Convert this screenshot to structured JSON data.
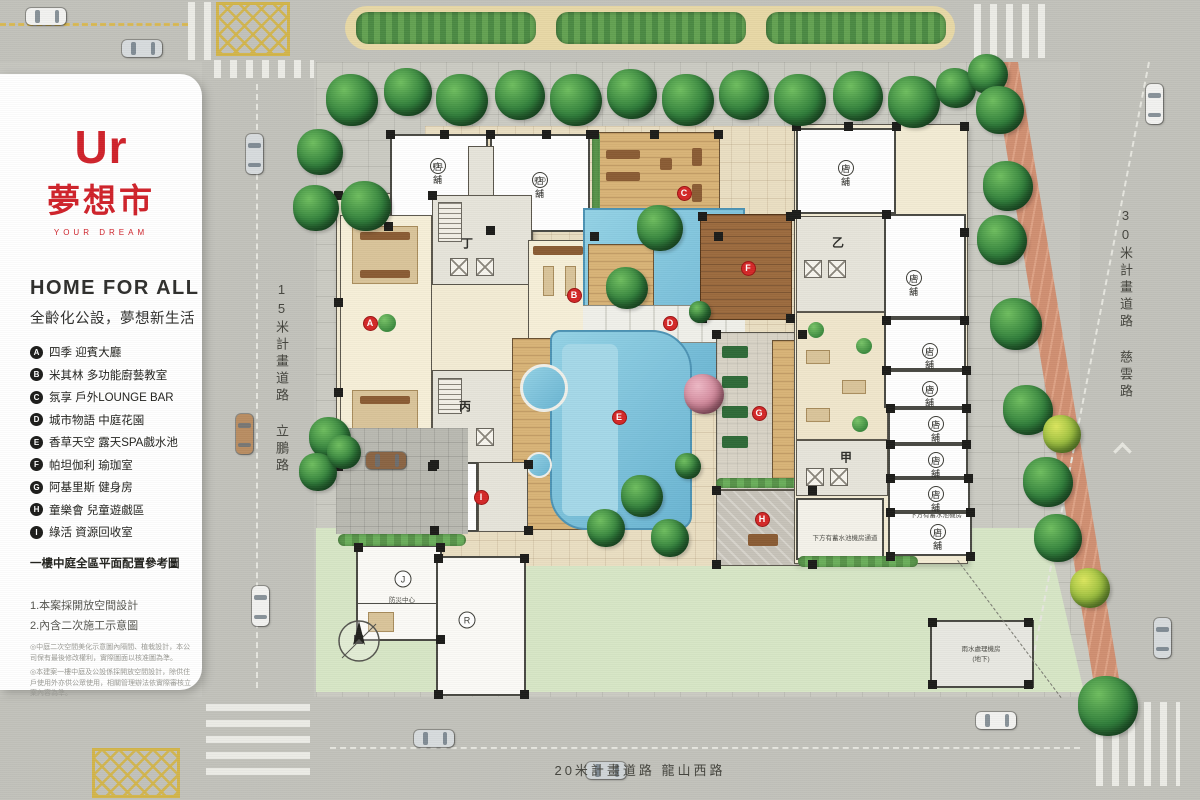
{
  "brand": {
    "logo_text": "Ur",
    "logo_cn": "夢想市",
    "logo_sub": "YOUR DREAM",
    "brand_color": "#d0232b"
  },
  "panel": {
    "title": "HOME FOR ALL",
    "subtitle": "全齡化公設，夢想新生活",
    "legend": [
      {
        "key": "A",
        "text": "四季 迎賓大廳"
      },
      {
        "key": "B",
        "text": "米其林 多功能廚藝教室"
      },
      {
        "key": "C",
        "text": "氛享 戶外LOUNGE BAR"
      },
      {
        "key": "D",
        "text": "城市物語 中庭花園"
      },
      {
        "key": "E",
        "text": "香草天空 露天SPA戲水池"
      },
      {
        "key": "F",
        "text": "帕坦伽利 瑜珈室"
      },
      {
        "key": "G",
        "text": "阿基里斯 健身房"
      },
      {
        "key": "H",
        "text": "童樂會 兒童遊戲區"
      },
      {
        "key": "I",
        "text": "綠活 資源回收室"
      }
    ],
    "caption": "一樓中庭全區平面配置參考圖",
    "notes": [
      "1.本案採開放空間設計",
      "2.內含二次施工示意圖"
    ],
    "fine_print": [
      "◎中庭二次空間美化示意圖內隔間、植栽設計，本公司保有最後修改權利，實際圖面以核准圖為準。",
      "◎本建案一樓中庭及公設係採開放空間設計，除供住戶使用外亦供公眾使用，相關管理辦法依實際審核立案內容為準。"
    ]
  },
  "roads": {
    "left_label": "15米計畫道路 立鵬路",
    "right_label": "30米計畫道路 慈雲路",
    "bottom_label": "20米計畫道路 龍山西路"
  },
  "plan": {
    "markers": [
      {
        "key": "A",
        "x": 370,
        "y": 323
      },
      {
        "key": "B",
        "x": 574,
        "y": 295
      },
      {
        "key": "C",
        "x": 684,
        "y": 193
      },
      {
        "key": "D",
        "x": 670,
        "y": 323
      },
      {
        "key": "E",
        "x": 619,
        "y": 417
      },
      {
        "key": "F",
        "x": 748,
        "y": 268
      },
      {
        "key": "G",
        "x": 759,
        "y": 413
      },
      {
        "key": "H",
        "x": 762,
        "y": 519
      },
      {
        "key": "I",
        "x": 481,
        "y": 497
      }
    ],
    "shops": [
      {
        "key": "P11",
        "label": "店舖",
        "x": 438,
        "y": 158
      },
      {
        "key": "P10",
        "label": "店舖",
        "x": 540,
        "y": 172
      },
      {
        "key": "P9",
        "label": "店舖",
        "x": 846,
        "y": 160
      },
      {
        "key": "P8",
        "label": "店舖",
        "x": 914,
        "y": 270
      },
      {
        "key": "P7",
        "label": "店舖",
        "x": 930,
        "y": 343
      },
      {
        "key": "P6",
        "label": "店舖",
        "x": 930,
        "y": 381
      },
      {
        "key": "P5",
        "label": "店舖",
        "x": 936,
        "y": 416
      },
      {
        "key": "P3",
        "label": "店舖",
        "x": 936,
        "y": 452
      },
      {
        "key": "P2",
        "label": "店舖",
        "x": 936,
        "y": 486
      },
      {
        "key": "P1",
        "label": "店舖",
        "x": 938,
        "y": 524
      }
    ],
    "towers": [
      {
        "key": "丁",
        "x": 467,
        "y": 243
      },
      {
        "key": "丙",
        "x": 465,
        "y": 406
      },
      {
        "key": "乙",
        "x": 838,
        "y": 242
      },
      {
        "key": "甲",
        "x": 846,
        "y": 457
      }
    ],
    "small_circles": [
      {
        "key": "J",
        "x": 403,
        "y": 579
      },
      {
        "key": "R",
        "x": 467,
        "y": 620
      }
    ],
    "annotations": [
      {
        "text": "防災中心",
        "x": 402,
        "y": 599
      },
      {
        "text": "下方有蓄水池機房",
        "x": 936,
        "y": 514
      },
      {
        "text": "下方有蓄水池機房通道",
        "x": 845,
        "y": 537
      },
      {
        "text": "雨水處理機房",
        "x": 981,
        "y": 648
      },
      {
        "text": "(地下)",
        "x": 981,
        "y": 658
      }
    ]
  },
  "palette": {
    "road": "#c6c6bf",
    "paving": "#cbcbc3",
    "lawn": "#d7e6c6",
    "water": "#7cc3dc",
    "wood": "#d8b377",
    "cream": "#f3ecd4",
    "tree_green": "#2f7d3a",
    "marker_red": "#d42828",
    "median_tan": "#e7d8a6",
    "brick": "#d08f72",
    "road_paint_yellow": "#d3b54b"
  }
}
